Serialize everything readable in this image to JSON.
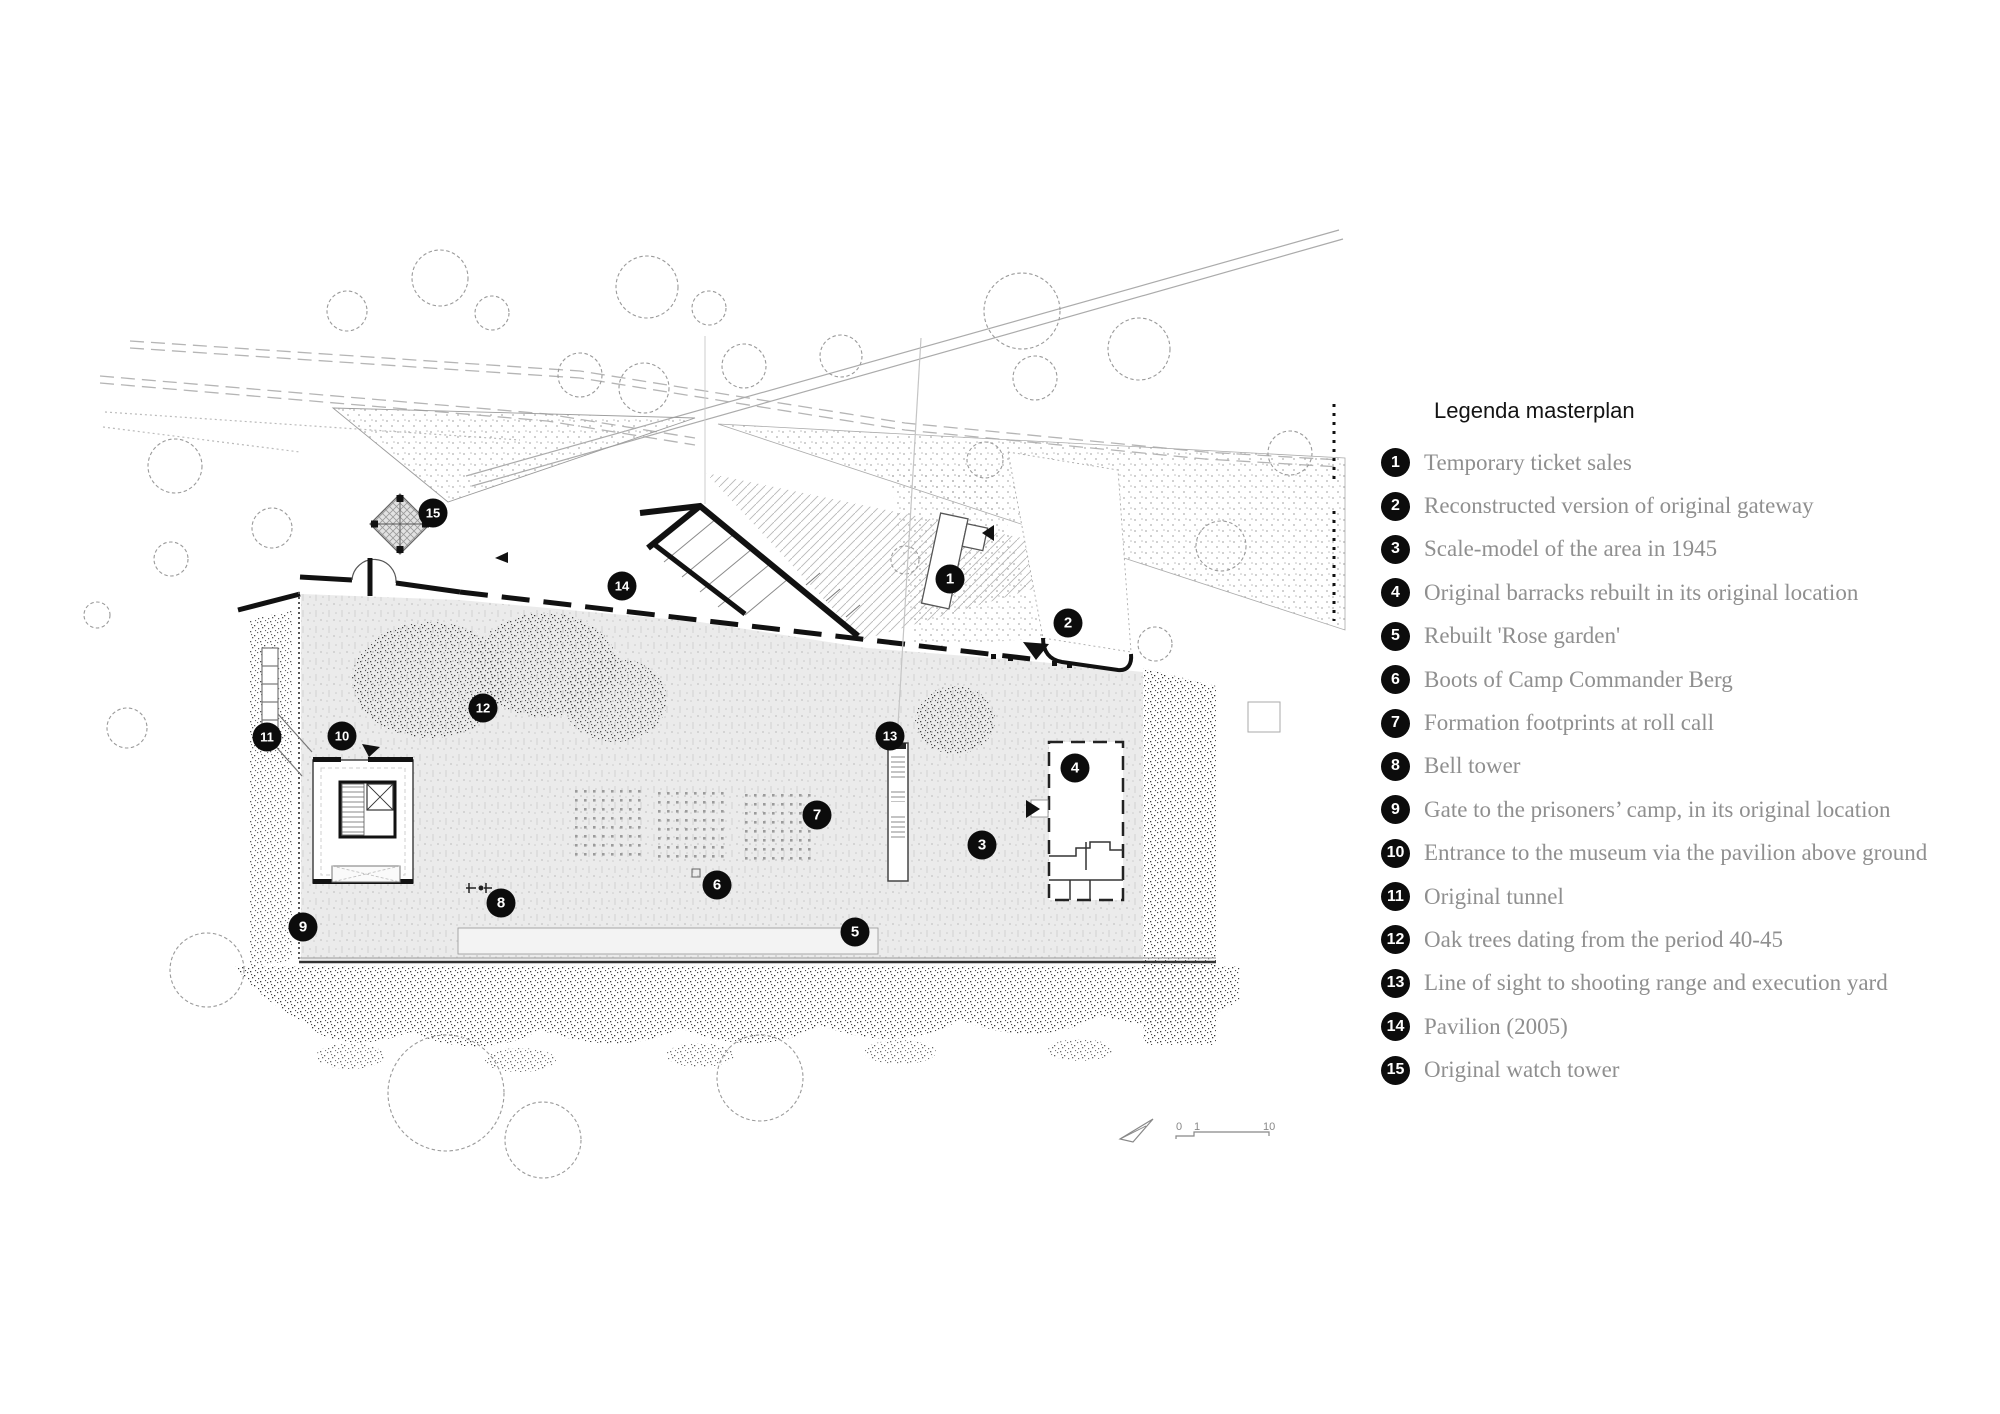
{
  "legend": {
    "title": "Legenda masterplan",
    "items": [
      {
        "n": "1",
        "label": "Temporary ticket sales"
      },
      {
        "n": "2",
        "label": "Reconstructed version of original gateway"
      },
      {
        "n": "3",
        "label": "Scale-model of the area in 1945"
      },
      {
        "n": "4",
        "label": "Original barracks rebuilt in its original location"
      },
      {
        "n": "5",
        "label": "Rebuilt 'Rose garden'"
      },
      {
        "n": "6",
        "label": "Boots of Camp Commander Berg"
      },
      {
        "n": "7",
        "label": "Formation footprints at roll call"
      },
      {
        "n": "8",
        "label": "Bell tower"
      },
      {
        "n": "9",
        "label": "Gate to the prisoners’ camp, in its original location"
      },
      {
        "n": "10",
        "label": "Entrance to the museum via the pavilion above ground"
      },
      {
        "n": "11",
        "label": "Original tunnel"
      },
      {
        "n": "12",
        "label": "Oak trees dating from the period 40-45"
      },
      {
        "n": "13",
        "label": "Line of sight to shooting range and execution yard"
      },
      {
        "n": "14",
        "label": "Pavilion (2005)"
      },
      {
        "n": "15",
        "label": "Original watch tower"
      }
    ]
  },
  "map": {
    "markers": [
      {
        "n": "1",
        "x": 950,
        "y": 579
      },
      {
        "n": "2",
        "x": 1068,
        "y": 623
      },
      {
        "n": "3",
        "x": 982,
        "y": 845
      },
      {
        "n": "4",
        "x": 1075,
        "y": 768
      },
      {
        "n": "5",
        "x": 855,
        "y": 932
      },
      {
        "n": "6",
        "x": 717,
        "y": 885
      },
      {
        "n": "7",
        "x": 817,
        "y": 815
      },
      {
        "n": "8",
        "x": 501,
        "y": 903
      },
      {
        "n": "9",
        "x": 303,
        "y": 927
      },
      {
        "n": "10",
        "x": 342,
        "y": 736
      },
      {
        "n": "11",
        "x": 267,
        "y": 737
      },
      {
        "n": "12",
        "x": 483,
        "y": 708
      },
      {
        "n": "13",
        "x": 890,
        "y": 736
      },
      {
        "n": "14",
        "x": 622,
        "y": 586
      },
      {
        "n": "15",
        "x": 433,
        "y": 513
      }
    ],
    "scale": {
      "labels": [
        "0",
        "1",
        "10"
      ]
    },
    "colors": {
      "marker_bg": "#0c0c0c",
      "marker_text": "#ffffff",
      "legend_text": "#8f8f8f",
      "boundary": "#111111",
      "hedge_dot": "#3c3c3c",
      "field_bg": "#ebebeb"
    }
  }
}
